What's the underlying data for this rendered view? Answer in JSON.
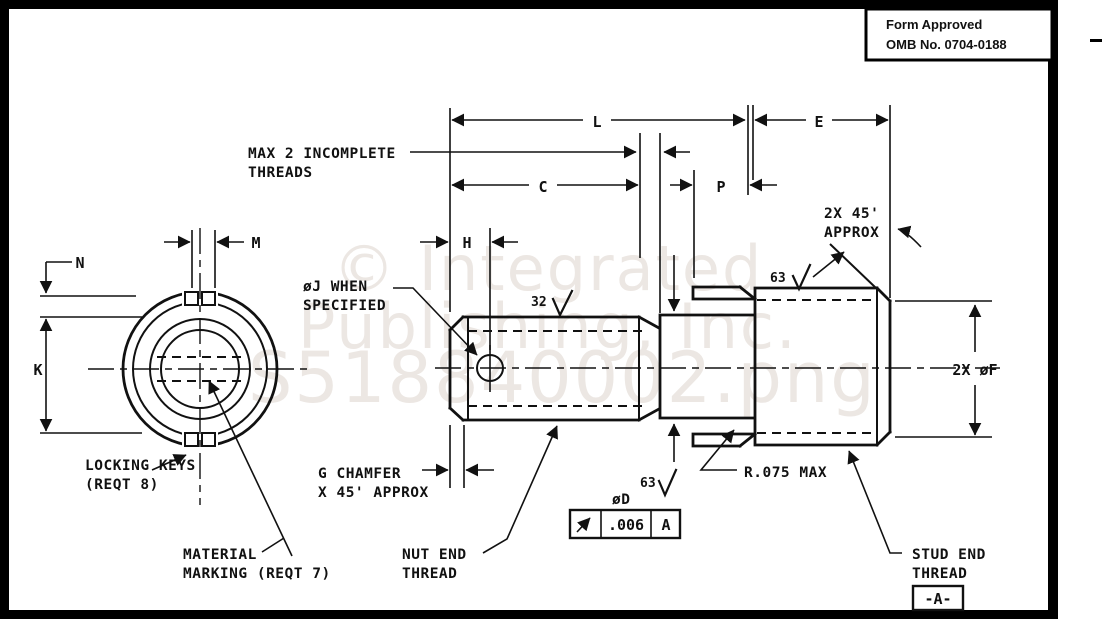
{
  "title_block": {
    "line1": "Form Approved",
    "line2": "OMB No. 0704-0188"
  },
  "watermark": {
    "line1": "© Integrated",
    "line2": "Publishing, Inc.",
    "line3": "S518840002.png"
  },
  "dimensions": {
    "L": "L",
    "E": "E",
    "C": "C",
    "P": "P",
    "H": "H",
    "M": "M",
    "N": "N",
    "K": "K",
    "stud_diameter": "2X øF",
    "neck_diameter": "øD"
  },
  "surface_finish": {
    "nut": "32",
    "stud": "63",
    "neck": "63"
  },
  "notes": {
    "max_threads_1": "MAX 2 INCOMPLETE",
    "max_threads_2": "THREADS",
    "phi_j_1": "øJ WHEN",
    "phi_j_2": "SPECIFIED",
    "chamfer_2x_1": "2X 45'",
    "chamfer_2x_2": "APPROX",
    "g_chamfer_1": "G CHAMFER",
    "g_chamfer_2": "X 45' APPROX",
    "locking_keys_1": "LOCKING KEYS",
    "locking_keys_2": "(REQT 8)",
    "material_marking_1": "MATERIAL",
    "material_marking_2": "MARKING (REQT 7)",
    "nut_end_1": "NUT END",
    "nut_end_2": "THREAD",
    "stud_end_1": "STUD END",
    "stud_end_2": "THREAD",
    "radius_max": "R.075 MAX"
  },
  "feature_control_frame": {
    "value": ".006",
    "datum": "A"
  },
  "datum_flag": "-A-"
}
